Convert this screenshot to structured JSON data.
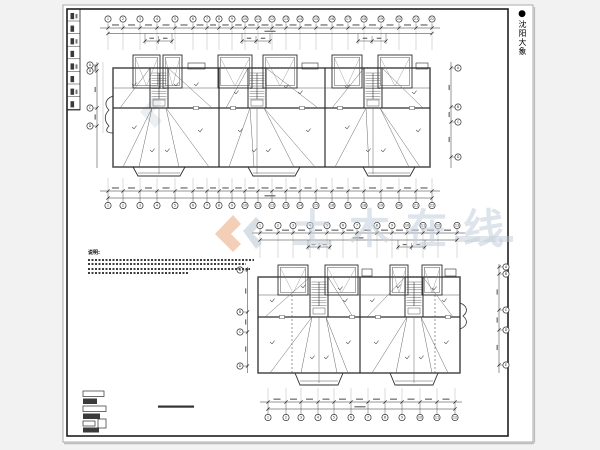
{
  "palette": {
    "bg": "#f2f2f2",
    "paper": "#ffffff",
    "frame": "#1f1f1f",
    "line": "#2e2e2e",
    "thin": "#555555",
    "faint": "#999999",
    "diag": "#666666",
    "watermark_text": "#c6d2dd",
    "watermark_orange": "#e9a87d",
    "watermark_gray": "#b9c6d0",
    "shadow": "#bdbdbd"
  },
  "side_tab": {
    "dot": "●",
    "label": "沈阳大象"
  },
  "watermark": {
    "text": "土木在线"
  },
  "notes": {
    "heading": "说明:",
    "line_count": 4
  },
  "axes": {
    "top_plan_top": [
      "1",
      "2",
      "3",
      "4",
      "5",
      "6",
      "7",
      "8",
      "9",
      "10",
      "11",
      "12",
      "13",
      "14",
      "15",
      "16",
      "17",
      "18",
      "19",
      "20",
      "21",
      "22"
    ],
    "top_plan_bottom": [
      "1",
      "2",
      "3",
      "4",
      "5",
      "6",
      "7",
      "8",
      "9",
      "10",
      "11",
      "12",
      "13",
      "14",
      "15",
      "16",
      "17",
      "18",
      "19",
      "20",
      "21",
      "22"
    ],
    "top_plan_left": [
      "A",
      "B",
      "C",
      "D"
    ],
    "top_plan_right": [
      "A",
      "B",
      "C",
      "D"
    ],
    "bottom_plan_top": [
      "1",
      "2",
      "3",
      "4",
      "5",
      "6",
      "7",
      "8",
      "9",
      "10",
      "11",
      "12",
      "13"
    ],
    "bottom_plan_bottom": [
      "1",
      "2",
      "3",
      "4",
      "5",
      "6",
      "7",
      "8",
      "9",
      "10",
      "11",
      "12"
    ],
    "bottom_plan_left": [
      "A",
      "B",
      "C",
      "D"
    ],
    "bottom_plan_right": [
      "A",
      "B",
      "C",
      "D",
      "E"
    ]
  }
}
